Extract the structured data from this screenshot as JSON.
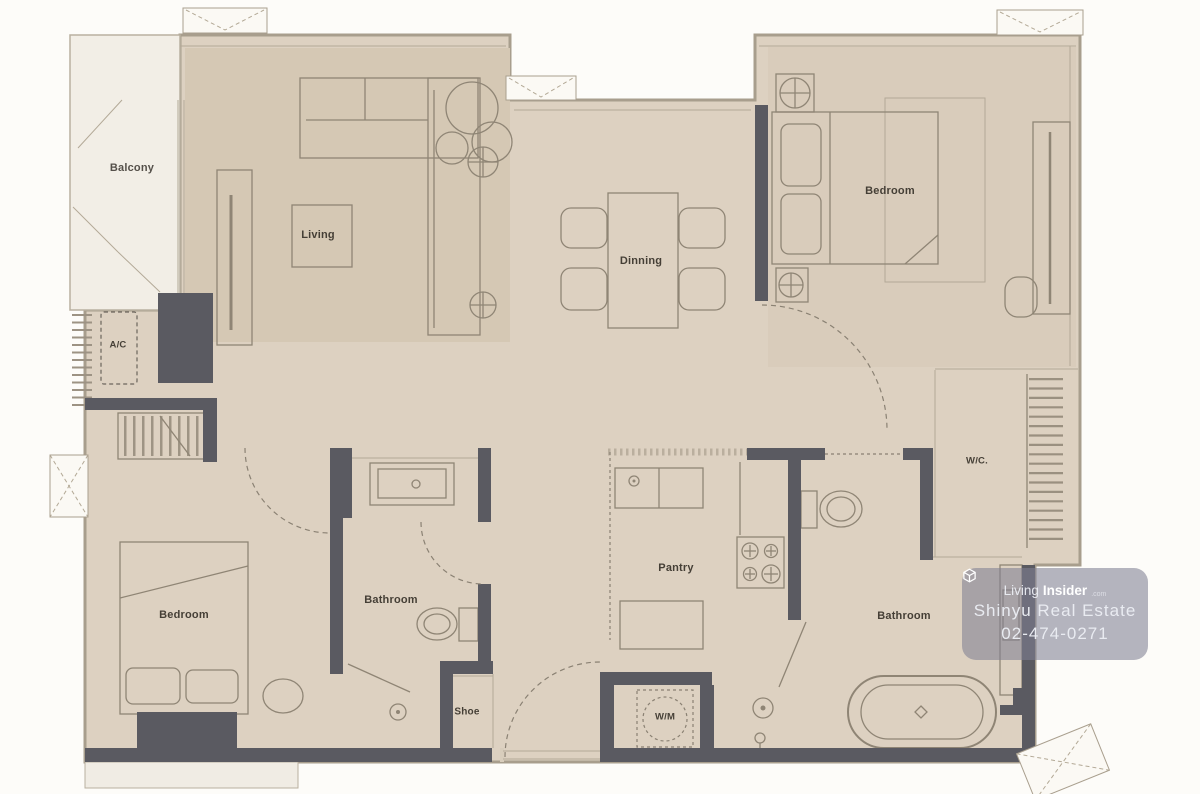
{
  "rooms": {
    "balcony": "Balcony",
    "living": "Living",
    "dining": "Dinning",
    "bedroom_top": "Bedroom",
    "bedroom_bottom": "Bedroom",
    "bathroom_mid": "Bathroom",
    "bathroom_right": "Bathroom",
    "pantry": "Pantry",
    "walk_in_closet": "W/C.",
    "ac_unit": "A/C",
    "washing_machine": "W/M",
    "shoe_cabinet": "Shoe"
  },
  "watermark": {
    "logo_icon": "cube-box-icon",
    "brand_prefix": "Living",
    "brand_suffix": "Insider",
    "brand_tld": ".com",
    "line1": "Shinyu Real Estate",
    "line2": "02-474-0271"
  },
  "colors": {
    "floor": "#ddd1c1",
    "floor_living": "#d5c8b4",
    "floor_bedroom": "#d9ccbb",
    "balcony": "#f2eee6",
    "wall": "#5a5a61",
    "stroke": "#8f8575",
    "label_text": "#453f36",
    "watermark_bg": "rgba(128,128,146,0.58)"
  }
}
